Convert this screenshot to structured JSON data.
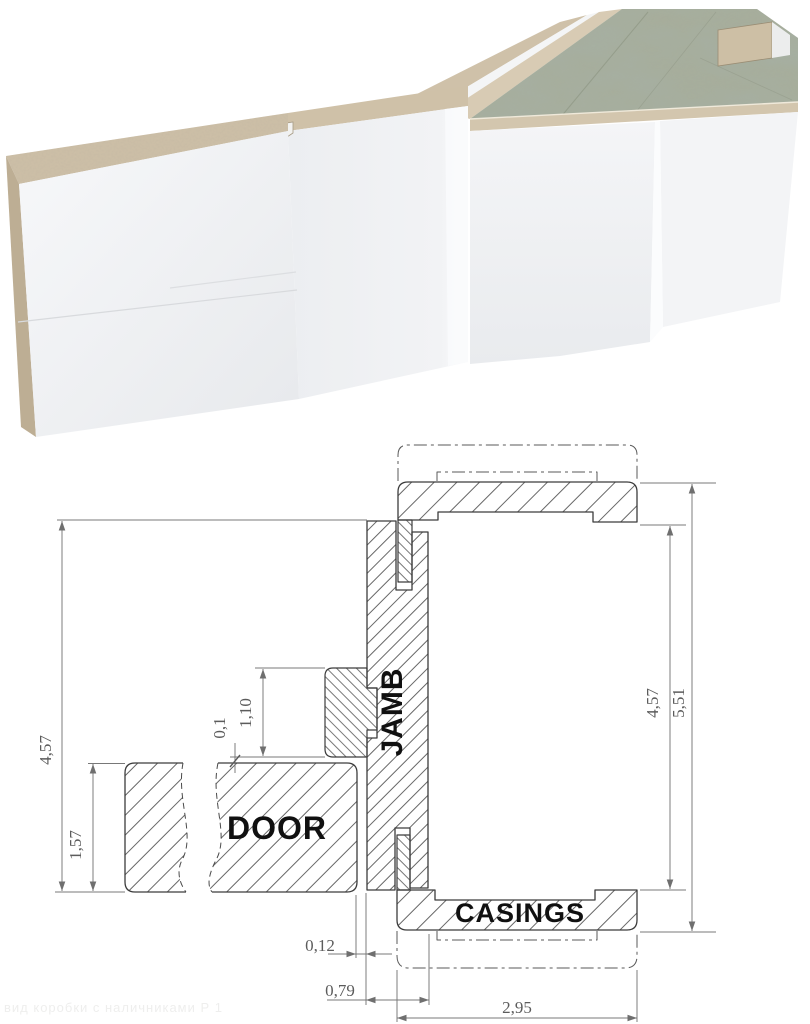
{
  "drawing": {
    "labels": {
      "door": "DOOR",
      "jamb": "JAMB",
      "casings": "CASINGS"
    },
    "dimensions": {
      "frame_height_left": "4,57",
      "door_thickness": "1,57",
      "doorstop_width": "1,10",
      "door_clearance": "0,1",
      "opening_height_right": "4,57",
      "overall_height_right": "5,51",
      "door_jamb_gap": "0,12",
      "jamb_depth": "0,79",
      "casing_width": "2,95"
    },
    "watermark": "вид коробки с наличниками Р 1"
  },
  "colors": {
    "mdf_tan": "#cdbfa7",
    "marble_top": "#a6ab9a",
    "white_face": "#f0f1f4",
    "outline": "#3c3c3c",
    "dimension": "#757575",
    "label_text": "#101010"
  }
}
